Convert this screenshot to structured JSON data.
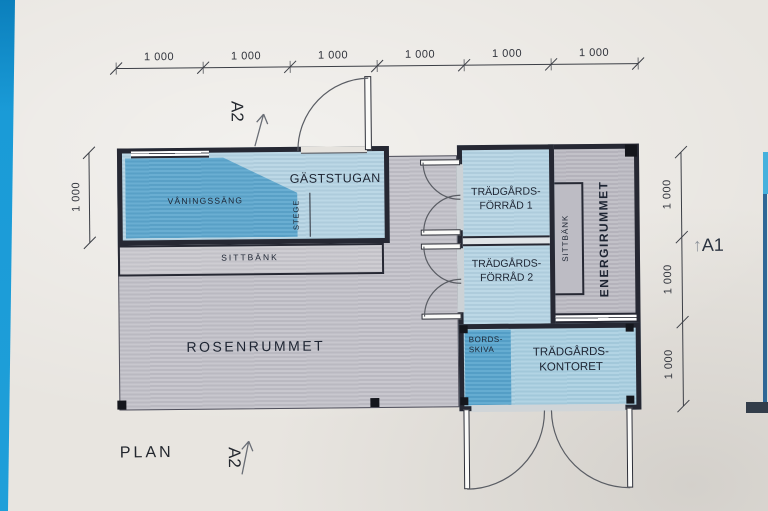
{
  "drawing": {
    "title": "PLAN",
    "section_markers": {
      "a1": "A1",
      "a2_top": "A2",
      "a2_bottom": "A2",
      "arrow_up": "↑"
    },
    "dims": {
      "top": [
        "1 000",
        "1 000",
        "1 000",
        "1 000",
        "1 000",
        "1 000"
      ],
      "left": [
        "1 000"
      ],
      "right": [
        "1 000",
        "1 000",
        "1 000"
      ]
    },
    "rooms": {
      "gaststugan": {
        "label": "GÄSTSTUGAN"
      },
      "vaningssang": {
        "label": "VÅNINGSSÄNG"
      },
      "stege": {
        "label": "STEGE"
      },
      "sittbank_band": {
        "label": "SITTBÄNK"
      },
      "rosenrummet": {
        "label": "ROSENRUMMET"
      },
      "forrad1": {
        "line1": "TRÄDGÅRDS-",
        "line2": "FÖRRÅD 1"
      },
      "forrad2": {
        "line1": "TRÄDGÅRDS-",
        "line2": "FÖRRÅD 2"
      },
      "energirummet": {
        "label": "ENERGIRUMMET"
      },
      "sittbank_energi": {
        "label": "SITTBÄNK"
      },
      "bordsskiva": {
        "line1": "BORDS-",
        "line2": "SKIVA"
      },
      "kontoret": {
        "line1": "TRÄDGÅRDS-",
        "line2": "KONTORET"
      }
    },
    "colors": {
      "paper": "#e8e5e0",
      "photo_border_blue": "#1a9bd7",
      "wall": "#262833",
      "room_blue_light": "#b5d4e3",
      "furniture_blue": "#5da7ce",
      "floor_gray": "#c2c1c8",
      "ink": "#20262f"
    }
  }
}
